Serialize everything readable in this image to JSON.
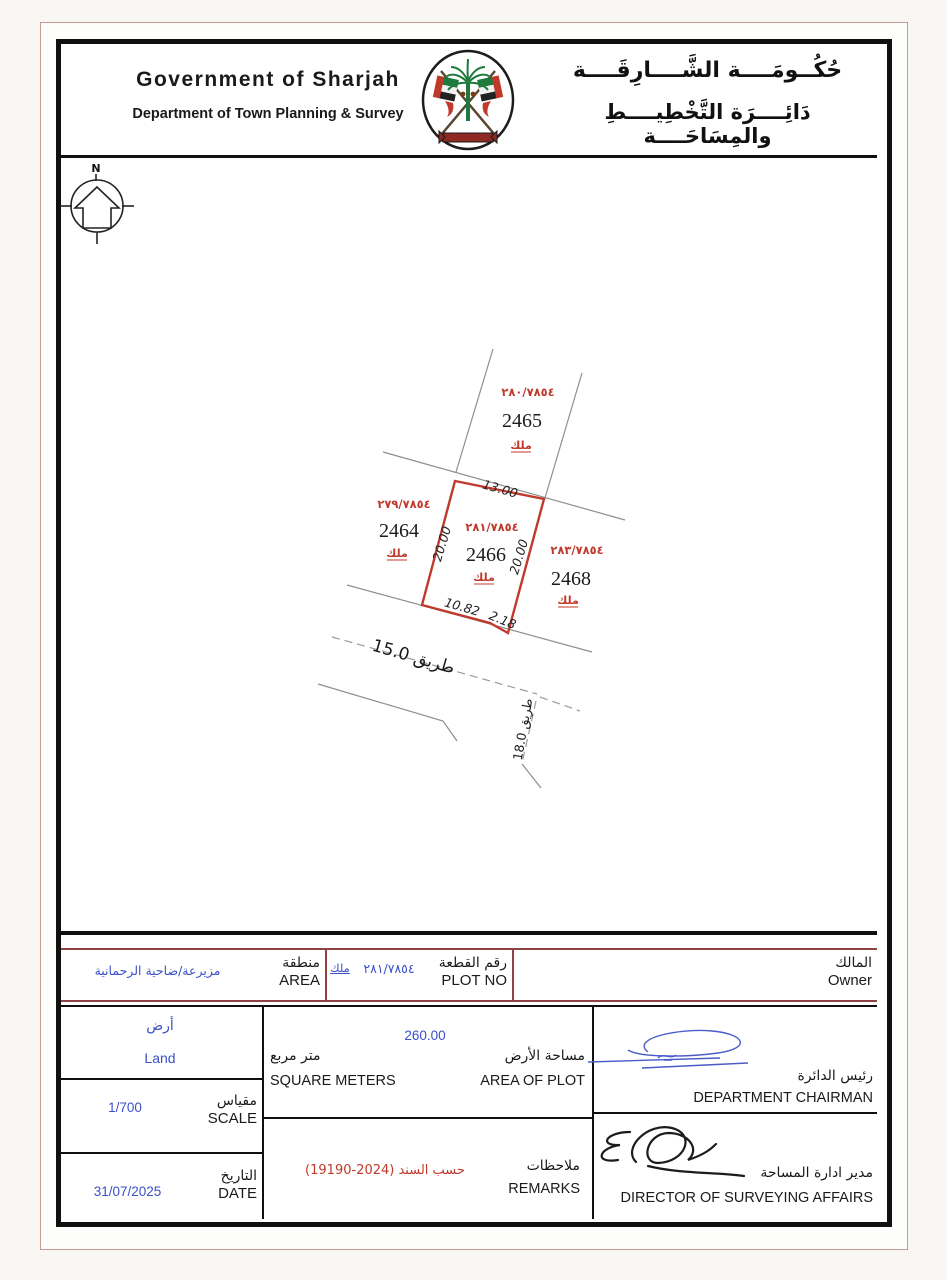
{
  "header": {
    "title_en": "Government of Sharjah",
    "subtitle_en": "Department of Town Planning & Survey",
    "title_ar": "حُكُــومَــــة الشَّــــارِقَــــة",
    "subtitle_ar": "دَائِــــرَة التَّخْطِيــــطِ والمِسَاحَــــة",
    "emblem_icon": "sharjah-emblem"
  },
  "map": {
    "north_label": "N",
    "plots": [
      {
        "number": "2465",
        "ref": "٢٨٠/٧٨٥٤",
        "tenure": "ملك"
      },
      {
        "number": "2464",
        "ref": "٢٧٩/٧٨٥٤",
        "tenure": "ملك"
      },
      {
        "number": "2466",
        "ref": "٢٨١/٧٨٥٤",
        "tenure": "ملك"
      },
      {
        "number": "2468",
        "ref": "٢٨٣/٧٨٥٤",
        "tenure": "ملك"
      }
    ],
    "dimensions": {
      "top": "13.00",
      "left_side": "20.00",
      "right_side": "20.00",
      "bottom": "10.82",
      "corner": "2.18"
    },
    "road_15_label": "طريق  15.0",
    "road_18_label": "طريق 18.0"
  },
  "owner_row": {
    "owner_label_ar": "المالك",
    "owner_label_en": "Owner",
    "plot_no_label_ar": "رقم القطعة",
    "plot_no_label_en": "PLOT NO",
    "plot_no_value": "٢٨١/٧٨٥٤",
    "plot_no_tenure": "ملك",
    "area_label_ar": "منطقة",
    "area_label_en": "AREA",
    "area_value": "مزيرعة/ضاحية الرحمانية"
  },
  "details": {
    "land_type_ar": "أرض",
    "land_type_en": "Land",
    "scale_label_ar": "مقياس",
    "scale_label_en": "SCALE",
    "scale_value": "1/700",
    "date_label_ar": "التاريخ",
    "date_label_en": "DATE",
    "date_value": "31/07/2025",
    "plot_area_label_ar": "مساحة الأرض",
    "plot_area_label_en": "AREA OF PLOT",
    "unit_label_ar": "متر مربع",
    "unit_label_en": "SQUARE METERS",
    "plot_area_value": "260.00",
    "remarks_label_ar": "ملاحظات",
    "remarks_label_en": "REMARKS",
    "remarks_value": "حسب السند (2024-19190)",
    "chairman_label_ar": "رئيس الدائرة",
    "chairman_label_en": "DEPARTMENT CHAIRMAN",
    "director_label_ar": "مدير ادارة المساحة",
    "director_label_en": "DIRECTOR OF SURVEYING AFFAIRS"
  },
  "colors": {
    "map_red": "#c03a2b",
    "value_blue": "#3a50c8",
    "table_maroon": "#8e4343",
    "line_gray": "#8f8f8f"
  }
}
